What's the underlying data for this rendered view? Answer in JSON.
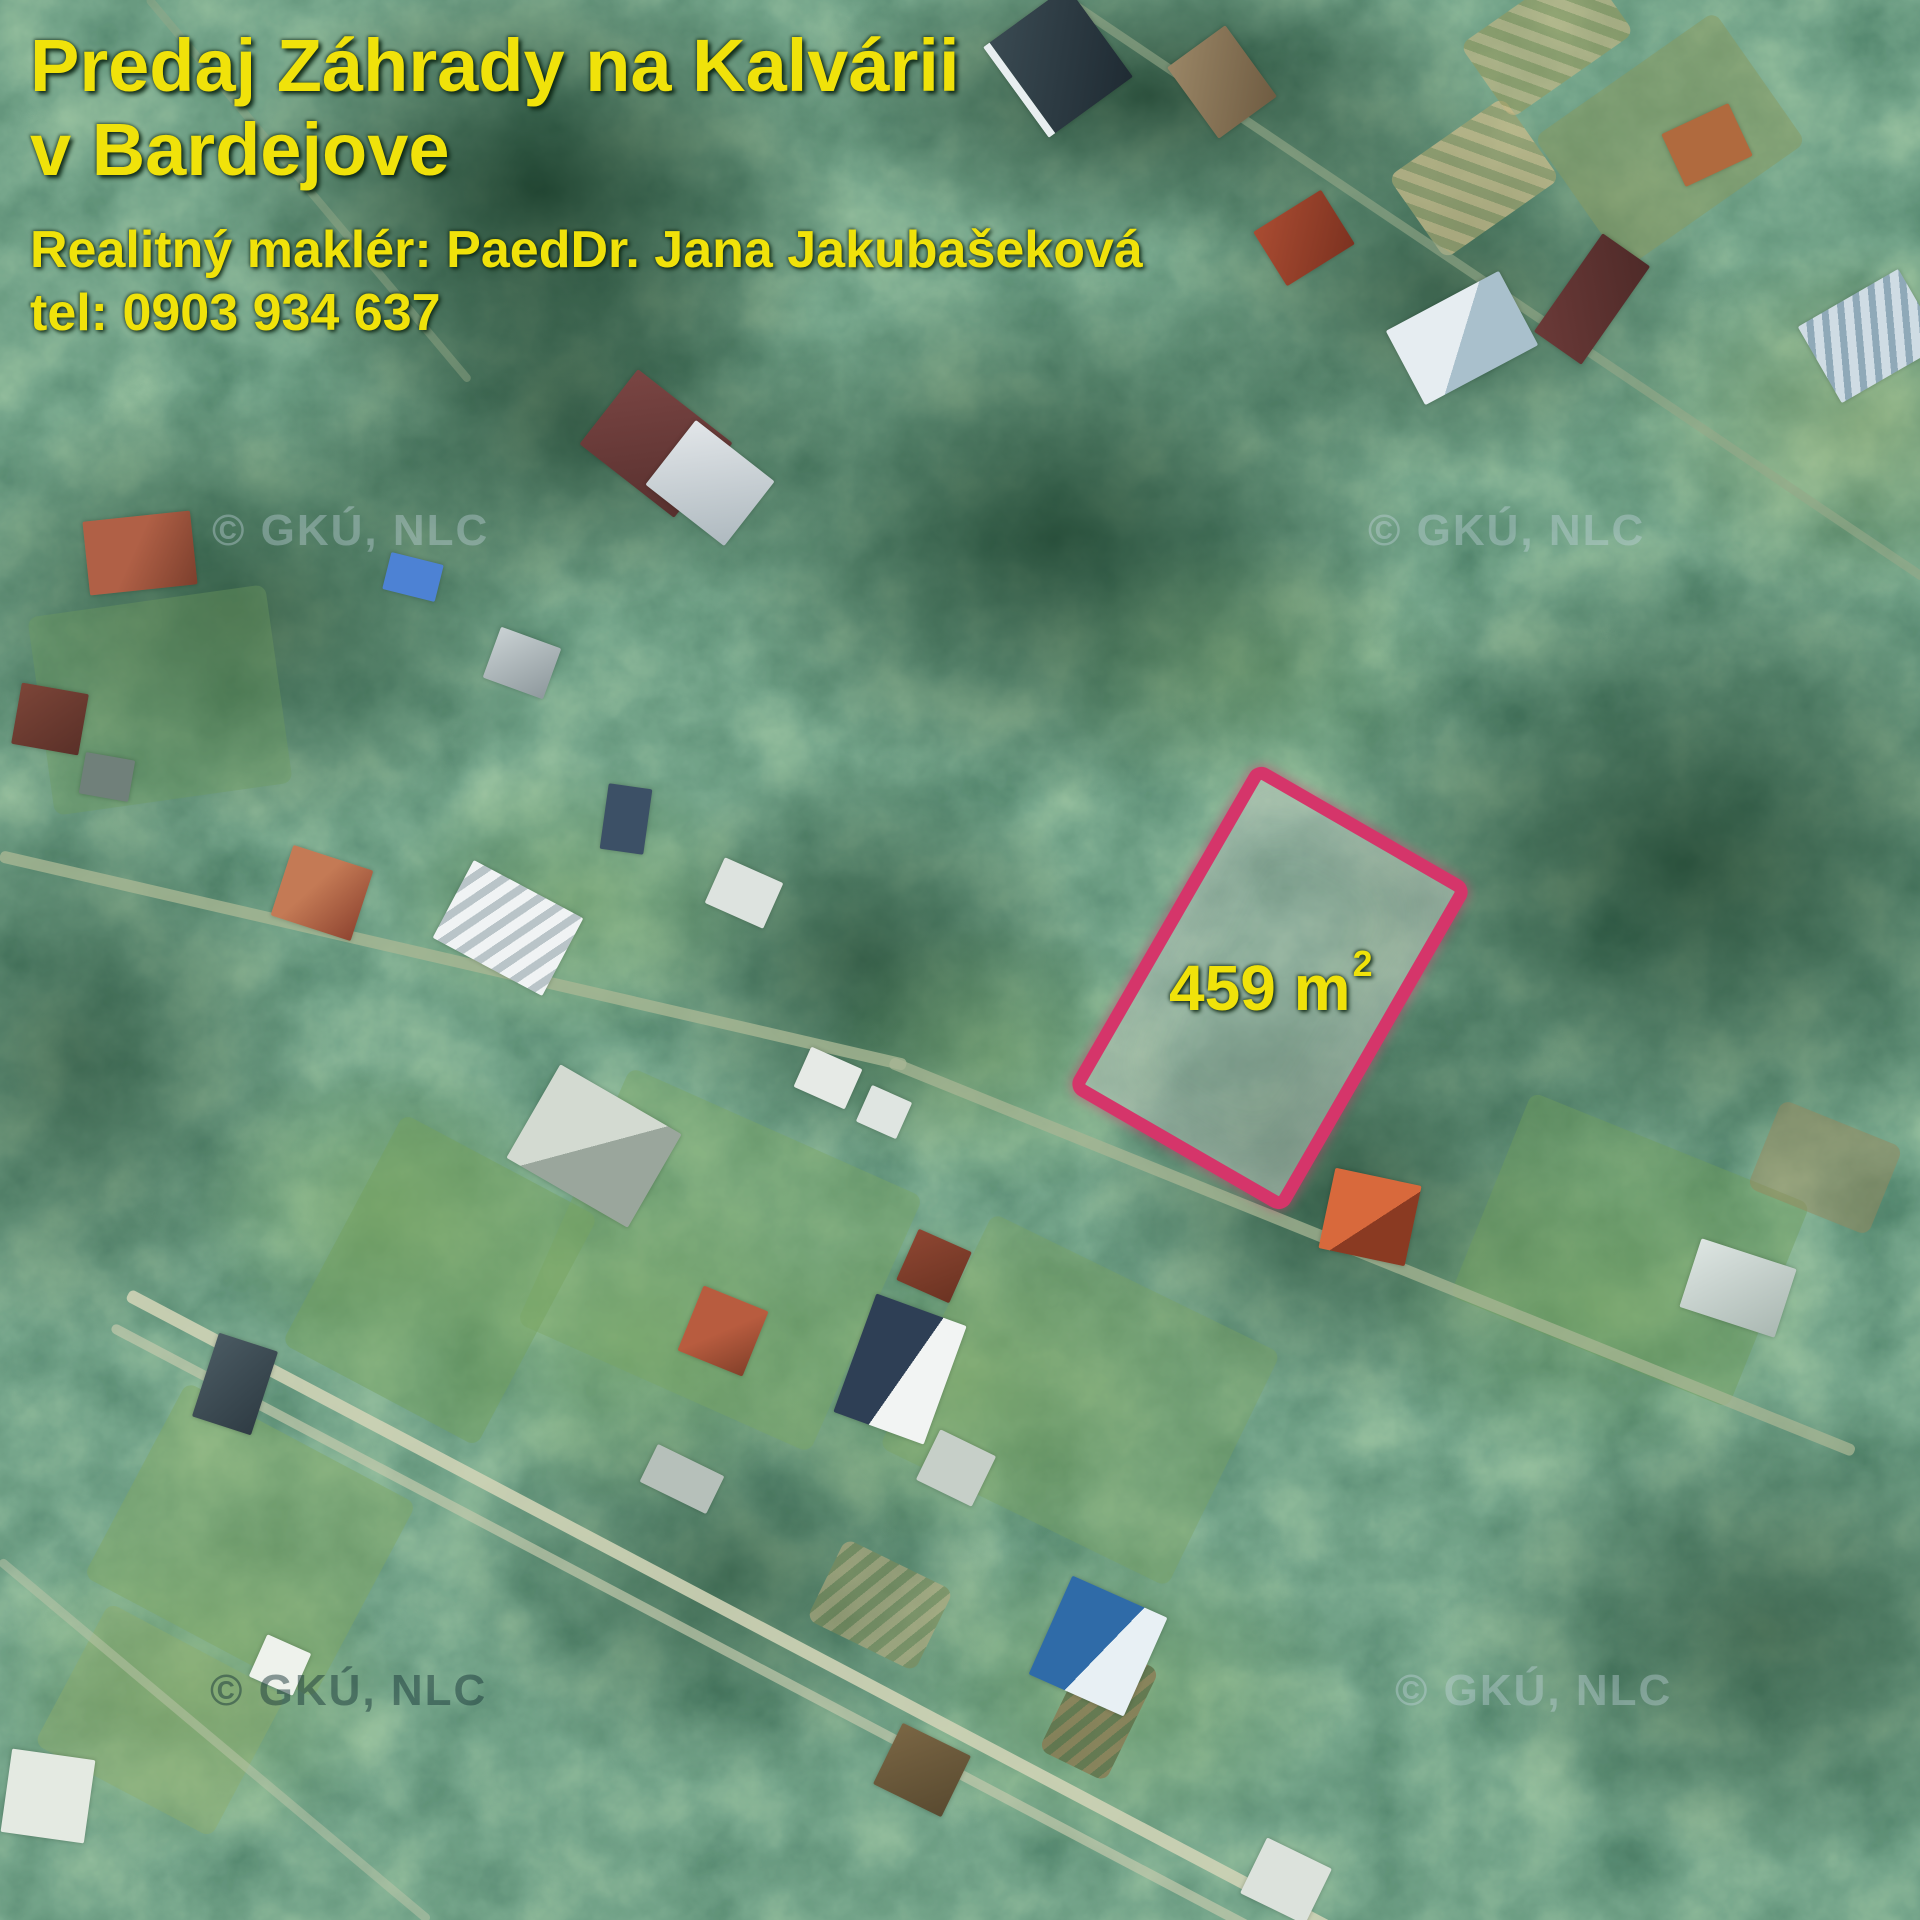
{
  "listing": {
    "title": "Predaj Záhrady na Kalvárii\nv Bardejove",
    "agent": "Realitný maklér: PaedDr. Jana Jakubašeková",
    "phone": "tel: 0903 934 637",
    "text_color": "#f0e20a"
  },
  "plot": {
    "area_label": "459 m",
    "area_superscript": "2",
    "outline_color": "#d5356a",
    "label_color": "#f0e20a"
  },
  "watermark": {
    "text": "© GKÚ, NLC"
  }
}
